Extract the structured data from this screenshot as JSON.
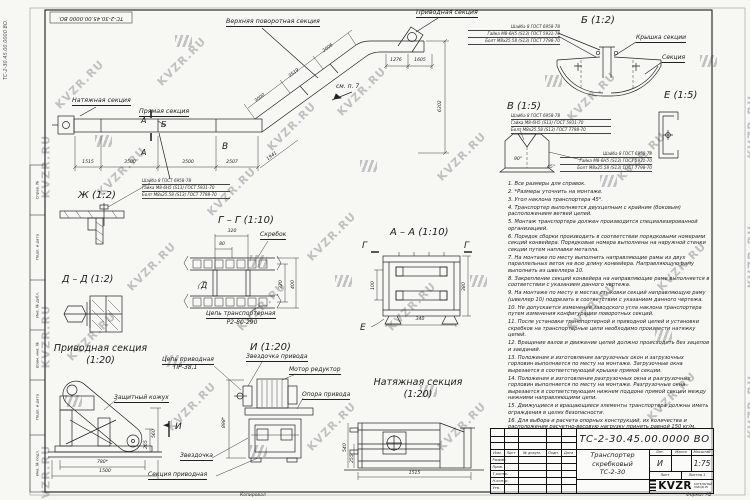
{
  "watermark": {
    "text": "KVZR.RU"
  },
  "corner": {
    "number_vertical": "ТС-2-30.45.00.0000 ВО.",
    "stamp_number": "ТС-2-30.45.00.0000 ВО."
  },
  "hw": [
    "Шайба 8 ГОСТ 6958-78",
    "Гайка М8-6Н5 (S13) ГОСТ 5931-70",
    "Болт М8х25.58 (S13) ГОСТ 7798-70"
  ],
  "main_view": {
    "tension_label": "Натяжная секция",
    "straight_label": "Прямая секция",
    "upper_turn_label": "Верхняя поворотная секция",
    "drive_label": "Приводная секция",
    "see_note": "см. п. 7",
    "marker_a": "А",
    "marker_b": "Б",
    "marker_v": "В",
    "dim_1515": "1515",
    "dim_3500a": "3500",
    "dim_3500b": "3500",
    "dim_2507": "2507",
    "dim_1941": "1941",
    "dim_3000": "3000",
    "dim_3519": "3519",
    "dim_2006": "2006",
    "dim_1276": "1276",
    "dim_1605": "1605",
    "dim_6302": "6302"
  },
  "detail_b": {
    "title": "Б (1:2)",
    "cover_label": "Крышка секции",
    "section_label": "Секция"
  },
  "detail_v": {
    "title": "В (1:5)",
    "angle_90": "90°",
    "angle_45": "45°"
  },
  "detail_e": {
    "title": "Е (1:5)"
  },
  "detail_zh": {
    "title": "Ж (1:2)"
  },
  "section_gg": {
    "title": "Г – Г (1:10)",
    "scraper_label": "Скребок",
    "chain_label_1": "Цепь транспортерная",
    "chain_label_2": "Р2-80-290",
    "marker_d": "Д",
    "dim_320h": "320",
    "dim_80": "80",
    "dim_320v": "320",
    "dim_400": "400"
  },
  "section_aa": {
    "title": "А – А (1:10)",
    "marker_g": "Г",
    "marker_e": "Е",
    "dim_100": "100",
    "dim_380": "380",
    "dim_340": "340"
  },
  "section_dd": {
    "title": "Д – Д (1:2)"
  },
  "drive_view": {
    "title_1": "Приводная секция",
    "title_2": "(1:20)",
    "cover_label": "Защитный кожух",
    "marker_i": "И",
    "dim_780": "780*",
    "dim_1500": "1500",
    "dim_560": "560",
    "dim_265": "265"
  },
  "i_view": {
    "title": "И (1:20)",
    "chain_label_1": "Цепь приводная",
    "chain_label_2": "ПР-38,1",
    "sprocket_drive_label": "Звездочка привода",
    "motor_label": "Мотор редуктор",
    "support_label": "Опора привода",
    "sprocket_label": "Звездочка",
    "section_label": "Секция приводная",
    "dim_898": "898*"
  },
  "tension_view": {
    "title_1": "Натяжная секция",
    "title_2": "(1:20)",
    "dim_1515": "1515",
    "dim_540": "540",
    "dim_255": "255"
  },
  "notes": [
    "1. Все размеры для справок.",
    "2. *Размеры уточнить на монтаже.",
    "3. Угол наклона транспортера 45°.",
    "4. Транспортер выполняется двухцепным с крайним (боковым) расположением ветвей цепей.",
    "5. Монтаж транспортера должен производится специализированной организацией.",
    "6. Порядок сборки производить в соответствии порядковыми номерами секций конвейера. Порядковые номера выполнены на наружной стенки секции путем наплавки металла.",
    "7. На монтаже по месту выполнить направляющие рамы из двух параллельных веток на всю длину конвейера. Направляющую раму выполнить из швеллера 10.",
    "8. Закрепление секций конвейера на направляющие раме выполняется в соответствии с указанием данного чертежа.",
    "9. На монтаже по месту в местах стыковки секций направляющую раму (швеллер 10) подрезать в соответствии с указанием данного чертежа.",
    "10. Не допускается изменение заводского угла наклона транспортера путем изменения конфигурации поворотных секций.",
    "11. После установки транспортерной и приводной цепей и установки скребков на транспортерные цепи необходимо произвести натяжку цепей.",
    "12. Вращение валов и движение цепей должно происходить без зацепов и заеданий.",
    "13. Положения и изготовления загрузочных окон и загрузочных горловин выполняется по месту на монтаже. Загрузочные окна вырезается в соответствующей крышке прямой секции.",
    "14. Положения и изготовления разгрузочных окна и разгрузочных горловин выполняется по месту на монтаже. Разгрузочные окна вырезается в соответствующем нижнем поддоне прямой секции между нижними направляющими цепи.",
    "15. Движущиеся и вращающиеся элементы транспортера должны иметь ограждения в целях безопасности.",
    "16. Для выбора и расчета опорных конструкций, их количества и расположения расчетно-весовую нагрузку принять равной 150 кг/м."
  ],
  "title_block": {
    "number": "ТС-2-30.45.00.0000 ВО",
    "name_1": "Транспортер",
    "name_2": "скребковый",
    "name_3": "ТС-2-30",
    "litera": "И",
    "scale": "1:75",
    "h_lit": "Лит.",
    "h_mass": "Масса",
    "h_scale": "Масштаб",
    "h_sheet": "Лист",
    "h_sheets": "Листов 1",
    "c_izm": "Изм.",
    "c_list": "Лист",
    "c_doc": "№ докум.",
    "c_sign": "Подп.",
    "c_date": "Дата",
    "r_1": "Разраб.",
    "r_2": "Пров.",
    "r_3": "Т.контр.",
    "r_4": "Н.контр.",
    "r_5": "Утв.",
    "logo": "KVZR",
    "logo_sub_1": "КОТЕЛЬНЫЙ",
    "logo_sub_2": "ЗАВОД.РУ",
    "copied": "Копировал",
    "format": "Формат А2"
  },
  "side_strip": [
    "Справ. №",
    "Подп. и дата",
    "Инв. № дубл.",
    "Взам. инв. №",
    "Подп. и дата",
    "Инв. № подл."
  ]
}
